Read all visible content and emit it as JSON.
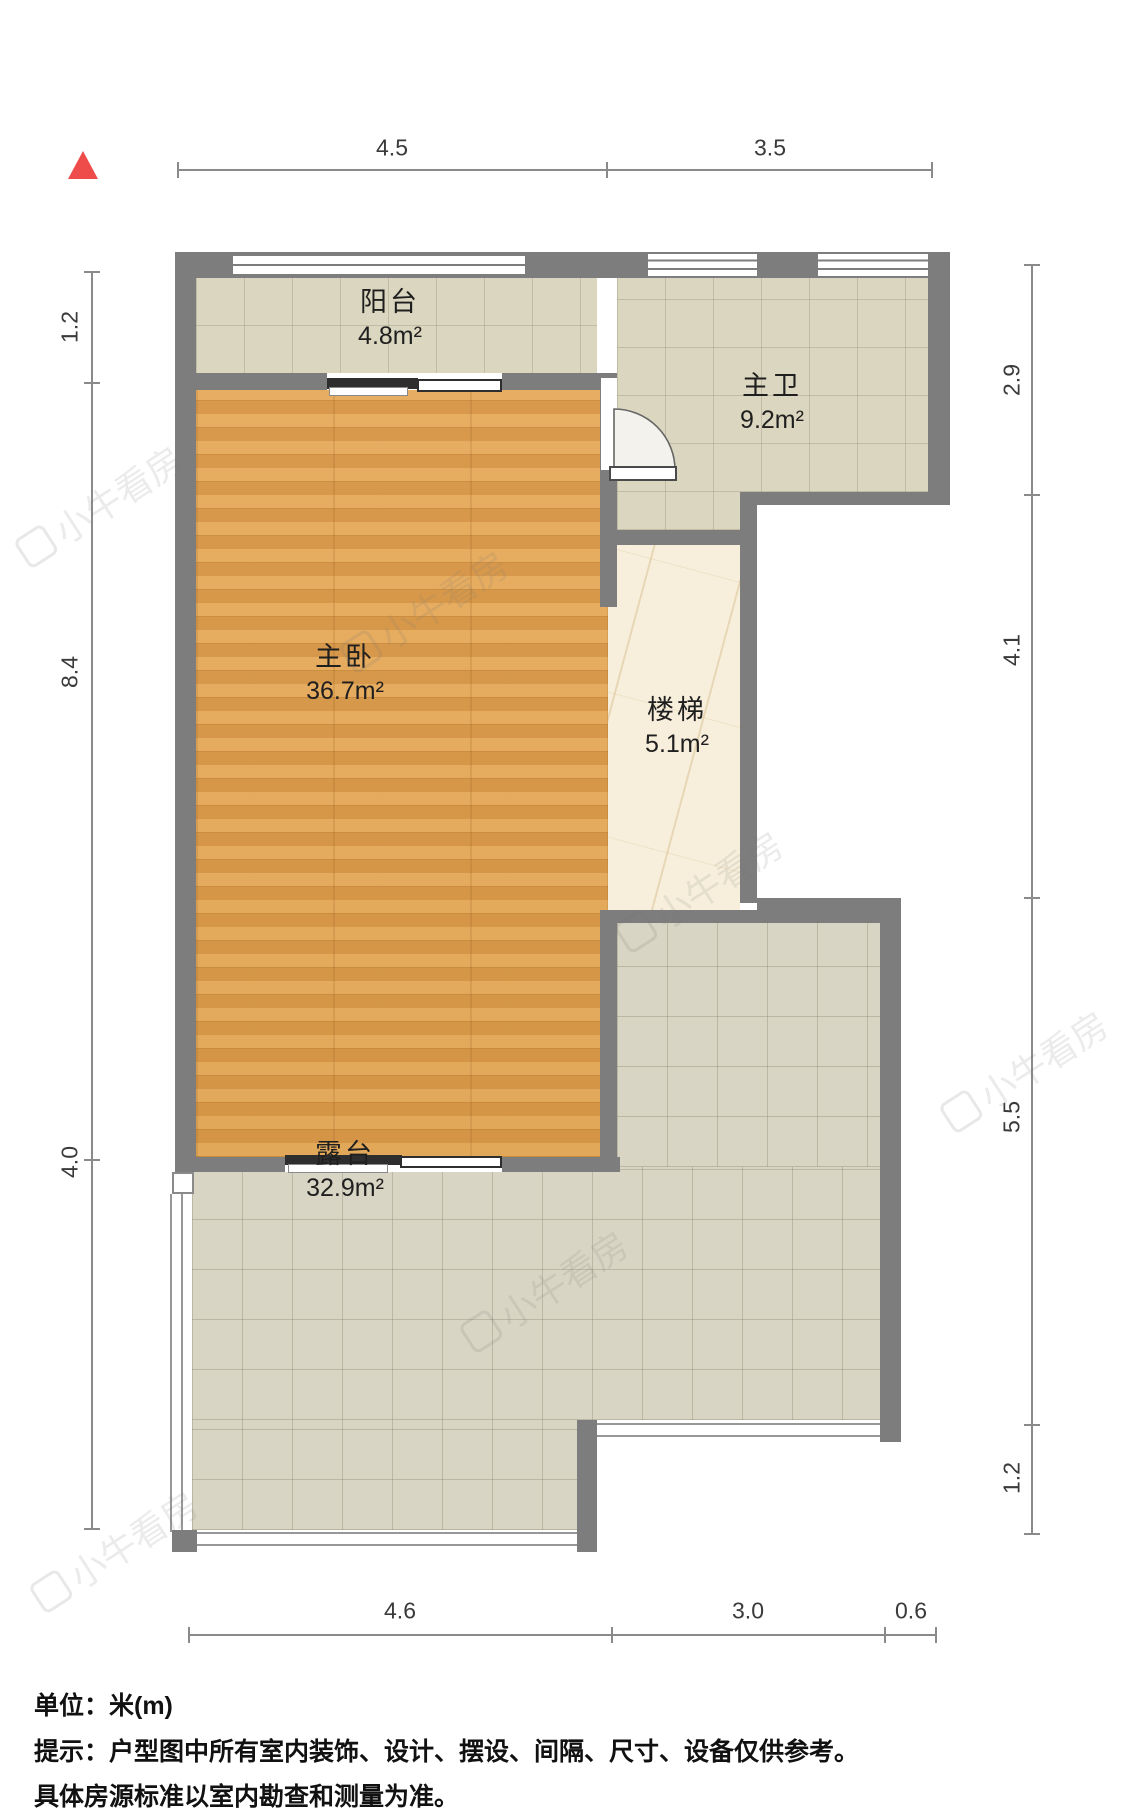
{
  "plan": {
    "rooms": [
      {
        "id": "balcony",
        "name": "阳台",
        "area": "4.8m²"
      },
      {
        "id": "master-bath",
        "name": "主卫",
        "area": "9.2m²"
      },
      {
        "id": "master-bedroom",
        "name": "主卧",
        "area": "36.7m²"
      },
      {
        "id": "stairs",
        "name": "楼梯",
        "area": "5.1m²"
      },
      {
        "id": "terrace",
        "name": "露台",
        "area": "32.9m²"
      }
    ],
    "dims": {
      "top": [
        "4.5",
        "3.5"
      ],
      "left": [
        "1.2",
        "8.4",
        "4.0"
      ],
      "right": [
        "2.9",
        "4.1",
        "5.5",
        "1.2"
      ],
      "bottom": [
        "4.6",
        "3.0",
        "0.6"
      ]
    },
    "colors": {
      "wall": "#7d7d7d",
      "wood_floor": "#e0a355",
      "tile_floor": "#dbd6bf",
      "terrace_floor": "#d8d5c4",
      "marble_floor": "#f7efdc",
      "north_arrow": "#ee4b4b",
      "dimension_line": "#8a8a8a"
    }
  },
  "watermark": {
    "text": "小牛看房"
  },
  "footer": {
    "unit_line": "单位：米(m)",
    "notice_line1": "提示：户型图中所有室内装饰、设计、摆设、间隔、尺寸、设备仅供参考。",
    "notice_line2": "具体房源标准以室内勘查和测量为准。"
  }
}
